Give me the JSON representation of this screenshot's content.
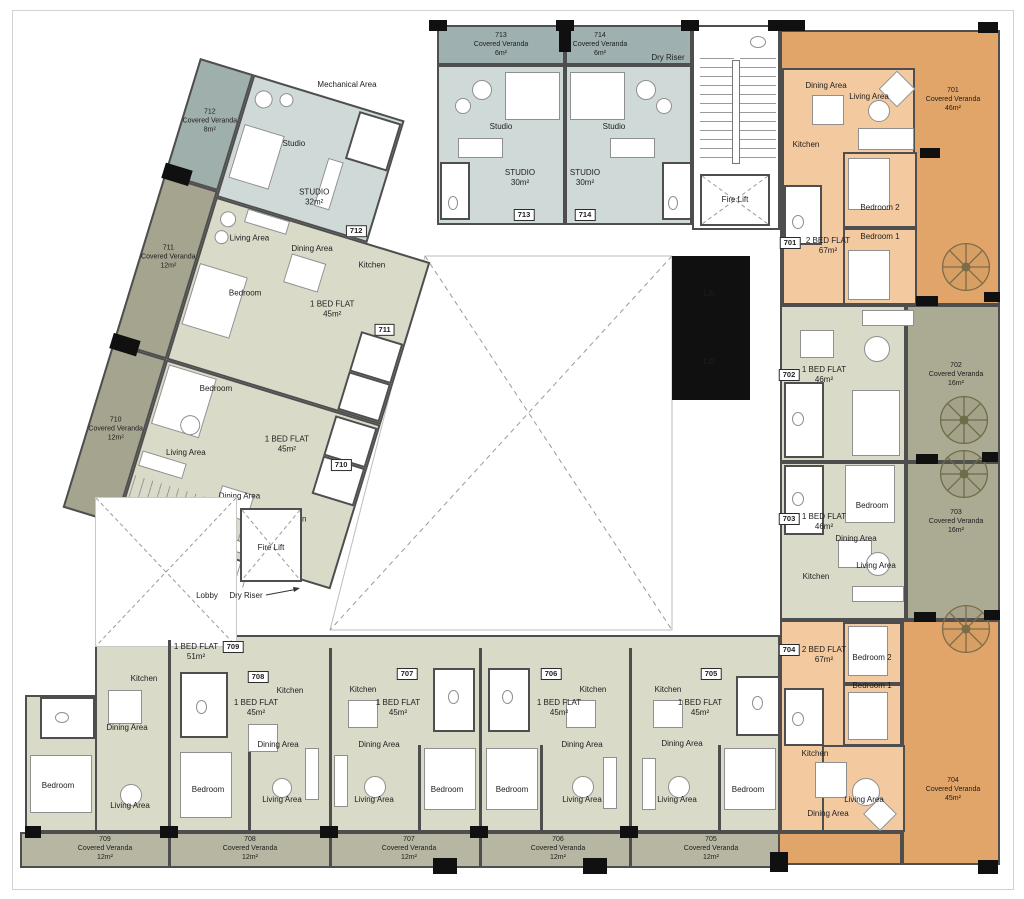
{
  "core": {
    "mechanical_area": "Mechanical Area",
    "dry_riser_top": "Dry Riser",
    "stair_fire_lift": "Fire Lift",
    "lift_a": "Lift",
    "lift_b": "Lift",
    "lobby": "Lobby",
    "lobby_dry_riser": "Dry Riser",
    "lobby_fire_lift": "Fire Lift"
  },
  "palette": {
    "beige_room": "#dadac9",
    "olive_veranda": "#a5a48f",
    "orange_room": "#f3c99f",
    "orange_veranda": "#e2a569",
    "studio_room": "#cfd9d8",
    "studio_veranda": "#9fb0b0",
    "wall": "#4e4e4e"
  },
  "units": {
    "u701": {
      "tag": "701",
      "type": "2 BED FLAT",
      "area": "67m²",
      "veranda": {
        "no": "701",
        "label": "Covered Veranda",
        "area": "46m²"
      },
      "rooms": {
        "dining": "Dining Area",
        "living": "Living Area",
        "kitchen": "Kitchen",
        "bedroom2": "Bedroom 2",
        "bedroom1": "Bedroom 1"
      }
    },
    "u702": {
      "tag": "702",
      "type": "1 BED FLAT",
      "area": "46m²",
      "veranda": {
        "no": "702",
        "label": "Covered Veranda",
        "area": "16m²"
      }
    },
    "u703": {
      "tag": "703",
      "type": "1 BED FLAT",
      "area": "46m²",
      "veranda": {
        "no": "703",
        "label": "Covered Veranda",
        "area": "16m²"
      },
      "rooms": {
        "bedroom": "Bedroom",
        "dining": "Dining Area",
        "living": "Living Area",
        "kitchen": "Kitchen"
      }
    },
    "u704": {
      "tag": "704",
      "type": "2 BED FLAT",
      "area": "67m²",
      "veranda": {
        "no": "704",
        "label": "Covered Veranda",
        "area": "45m²"
      },
      "rooms": {
        "bedroom2": "Bedroom 2",
        "bedroom1": "Bedroom 1",
        "kitchen": "Kitchen",
        "dining": "Dining Area",
        "living": "Living Area"
      }
    },
    "u705": {
      "tag": "705",
      "type": "1 BED FLAT",
      "area": "45m²",
      "veranda": {
        "no": "705",
        "label": "Covered Veranda",
        "area": "12m²"
      },
      "rooms": {
        "kitchen": "Kitchen",
        "dining": "Dining Area",
        "bedroom": "Bedroom",
        "living": "Living Area"
      }
    },
    "u706": {
      "tag": "706",
      "type": "1 BED FLAT",
      "area": "45m²",
      "veranda": {
        "no": "706",
        "label": "Covered Veranda",
        "area": "12m²"
      },
      "rooms": {
        "kitchen": "Kitchen",
        "dining": "Dining Area",
        "bedroom": "Bedroom",
        "living": "Living Area"
      }
    },
    "u707": {
      "tag": "707",
      "type": "1 BED FLAT",
      "area": "45m²",
      "veranda": {
        "no": "707",
        "label": "Covered Veranda",
        "area": "12m²"
      },
      "rooms": {
        "kitchen": "Kitchen",
        "dining": "Dining Area",
        "bedroom": "Bedroom",
        "living": "Living Area"
      }
    },
    "u708": {
      "tag": "708",
      "type": "1 BED FLAT",
      "area": "45m²",
      "veranda": {
        "no": "708",
        "label": "Covered Veranda",
        "area": "12m²"
      },
      "rooms": {
        "kitchen": "Kitchen",
        "dining": "Dining Area",
        "bedroom": "Bedroom",
        "living": "Living Area"
      }
    },
    "u709": {
      "tag": "709",
      "type": "1 BED FLAT",
      "area": "51m²",
      "veranda": {
        "no": "709",
        "label": "Covered Veranda",
        "area": "12m²"
      },
      "rooms": {
        "kitchen": "Kitchen",
        "dining": "Dining Area",
        "bedroom": "Bedroom",
        "living": "Living Area"
      }
    },
    "u710": {
      "tag": "710",
      "type": "1 BED FLAT",
      "area": "45m²",
      "veranda": {
        "no": "710",
        "label": "Covered Veranda",
        "area": "12m²"
      },
      "rooms": {
        "bedroom": "Bedroom",
        "living": "Living Area",
        "dining": "Dining Area",
        "kitchen": "Kitchen"
      }
    },
    "u711": {
      "tag": "711",
      "type": "1 BED FLAT",
      "area": "45m²",
      "veranda": {
        "no": "711",
        "label": "Covered Veranda",
        "area": "12m²"
      },
      "rooms": {
        "living": "Living Area",
        "dining": "Dining Area",
        "kitchen": "Kitchen",
        "bedroom": "Bedroom"
      }
    },
    "u712": {
      "tag": "712",
      "type": "STUDIO",
      "area": "32m²",
      "veranda": {
        "no": "712",
        "label": "Covered Veranda",
        "area": "8m²"
      },
      "rooms": {
        "studio": "Studio"
      }
    },
    "u713": {
      "tag": "713",
      "type": "STUDIO",
      "area": "30m²",
      "veranda": {
        "no": "713",
        "label": "Covered Veranda",
        "area": "6m²"
      },
      "rooms": {
        "studio": "Studio"
      }
    },
    "u714": {
      "tag": "714",
      "type": "STUDIO",
      "area": "30m²",
      "veranda": {
        "no": "714",
        "label": "Covered Veranda",
        "area": "6m²"
      },
      "rooms": {
        "studio": "Studio"
      }
    }
  }
}
